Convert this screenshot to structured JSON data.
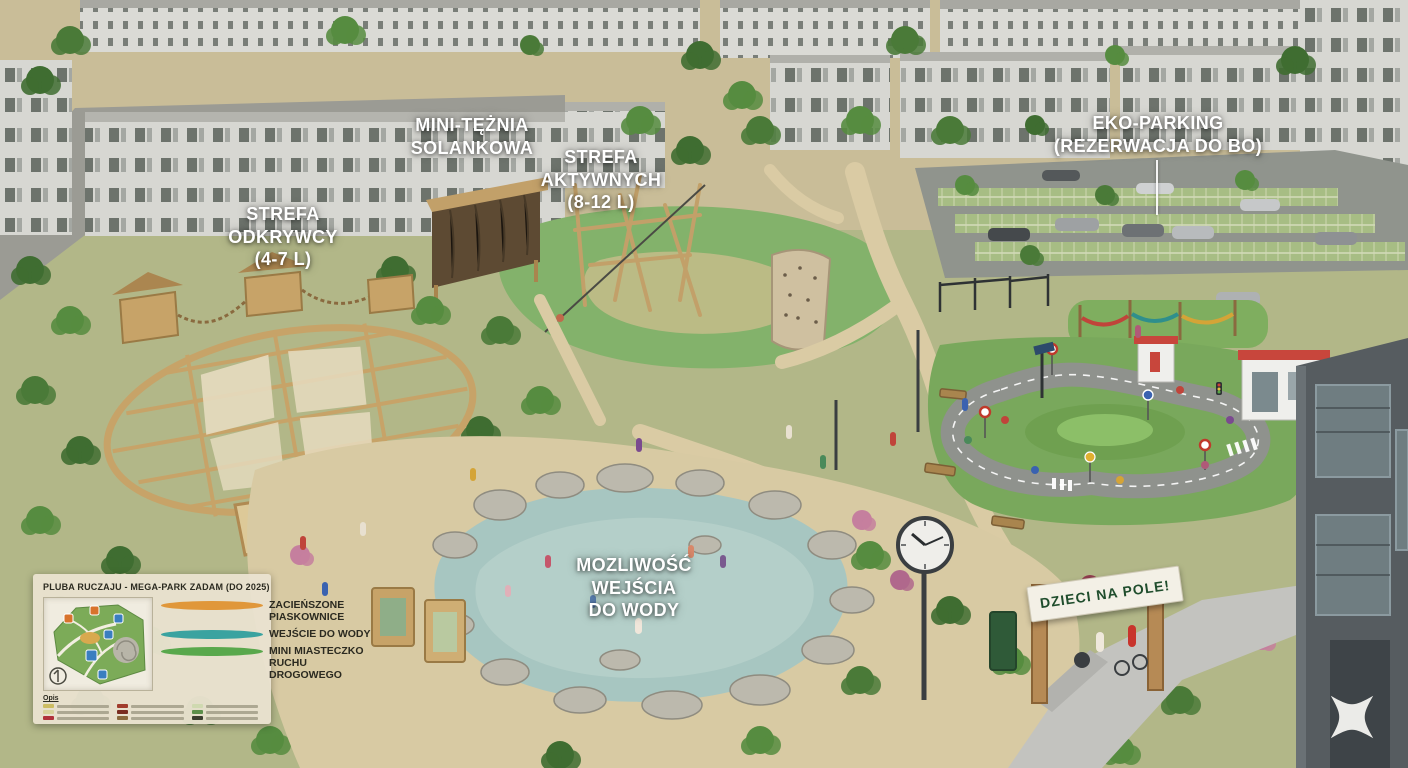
{
  "scene_title": "park concept aerial rendering",
  "labels": {
    "strefa_odkrywcy": "STREFA\nODKRYWCY\n(4-7 L)",
    "mini_teznia": "MINI-TĘŻNIA\nSOLANKOWA",
    "strefa_aktywnych": "STREFA\nAKTYWNYCH\n(8-12 L)",
    "eko_parking": "EKO-PARKING\n(REZERWACJA DO BO)",
    "wejscie_do_wody": "MOZLIWOŚĆ\nWEJŚCIA\nDO WODY",
    "banner_gate": "DZIECI NA POLE!"
  },
  "legend": {
    "title": "PLUBA RUCZAJU - MEGA-PARK ZADAM (DO 2025)",
    "items": [
      {
        "color": "#e0973a",
        "label": "ZACIEŃSZONE PIASKOWNICE"
      },
      {
        "color": "#3aa3a0",
        "label": "WEJŚCIE DO WODY"
      },
      {
        "color": "#59a84c",
        "label": "MINI MIASTECZKO RUCHU DROGOWEGO"
      }
    ],
    "map_caption": "Opis"
  },
  "clock": {
    "time_shown": "10:09"
  },
  "colors": {
    "label_text": "#ffffff",
    "banner_text": "#1f4d2c",
    "banner_bg": "#f3f0e6",
    "sand_path": "#d8caa3",
    "water": "#a7c6c1",
    "playground_rubber": "#83b26b",
    "wood": "#c7a368",
    "building_wall": "#d7d7d2",
    "dark_building": "#555b60"
  }
}
